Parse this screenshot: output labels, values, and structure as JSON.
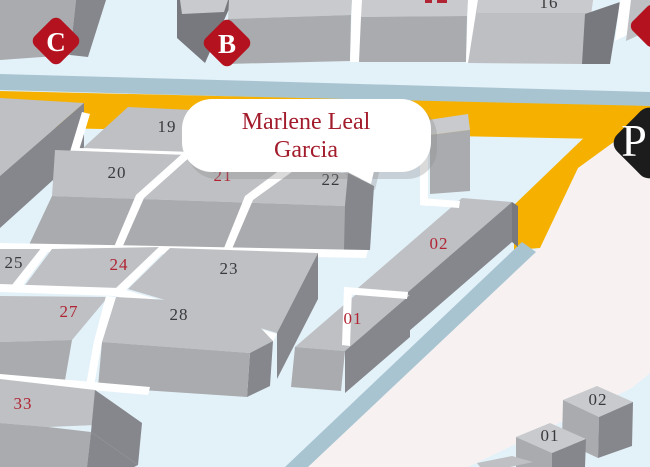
{
  "callout": {
    "line1": "Marlene Leal",
    "line2": "Garcia"
  },
  "markers": {
    "c": "C",
    "b": "B",
    "p": "P"
  },
  "lots": {
    "lot16": "16",
    "lot19": "19",
    "lot20": "20",
    "lot21": "21",
    "lot22": "22",
    "lot23": "23",
    "lot24": "24",
    "lot25": "25",
    "lot27": "27",
    "lot28": "28",
    "lot33": "33",
    "bar02": "02",
    "bar01": "01",
    "small02": "02",
    "small01": "01"
  },
  "colors": {
    "background_blue": "#E3F1F9",
    "road_blue_stripe": "#A9C4D1",
    "road_yellow": "#F6B100",
    "parking_zone": "#F7F2F1",
    "marker_red": "#B5121F",
    "marker_black": "#1C1C1C",
    "label_red": "#B02433",
    "label_dark": "#3A393C",
    "callout_text": "#A31C2C"
  }
}
